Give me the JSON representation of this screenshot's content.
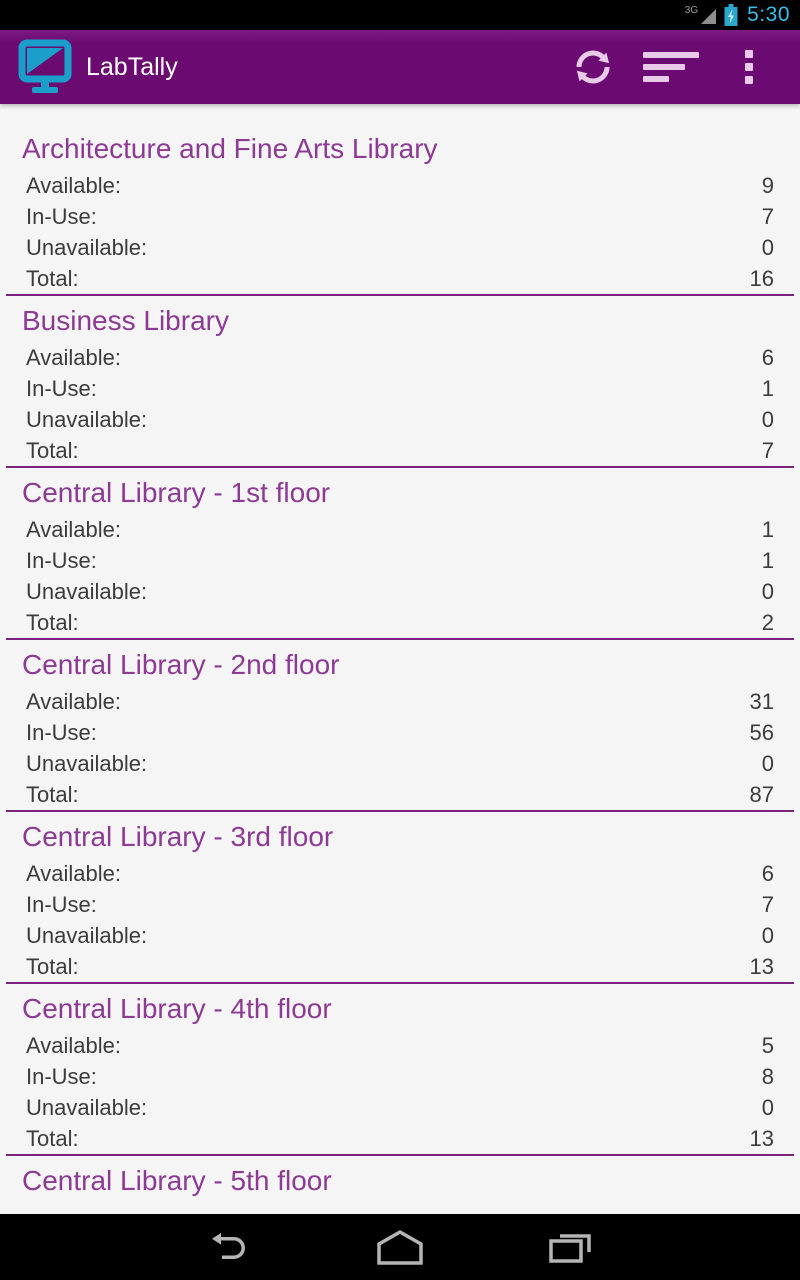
{
  "status_bar": {
    "network": "3G",
    "time": "5:30",
    "battery_state": "charging"
  },
  "action_bar": {
    "title": "LabTally",
    "app_icon": "monitor-icon",
    "buttons": [
      {
        "name": "refresh",
        "icon": "refresh-icon"
      },
      {
        "name": "sort",
        "icon": "sort-icon"
      },
      {
        "name": "overflow",
        "icon": "overflow-menu-icon"
      }
    ]
  },
  "row_labels": {
    "available": "Available:",
    "in_use": "In-Use:",
    "unavailable": "Unavailable:",
    "total": "Total:"
  },
  "row_keys": [
    "available",
    "in_use",
    "unavailable",
    "total"
  ],
  "sections": [
    {
      "name": "Architecture and Fine Arts Library",
      "available": 9,
      "in_use": 7,
      "unavailable": 0,
      "total": 16
    },
    {
      "name": "Business Library",
      "available": 6,
      "in_use": 1,
      "unavailable": 0,
      "total": 7
    },
    {
      "name": "Central Library - 1st floor",
      "available": 1,
      "in_use": 1,
      "unavailable": 0,
      "total": 2
    },
    {
      "name": "Central Library - 2nd floor",
      "available": 31,
      "in_use": 56,
      "unavailable": 0,
      "total": 87
    },
    {
      "name": "Central Library - 3rd floor",
      "available": 6,
      "in_use": 7,
      "unavailable": 0,
      "total": 13
    },
    {
      "name": "Central Library - 4th floor",
      "available": 5,
      "in_use": 8,
      "unavailable": 0,
      "total": 13
    },
    {
      "name": "Central Library - 5th floor",
      "partial": true
    }
  ],
  "nav_bar": {
    "buttons": [
      {
        "name": "back",
        "icon": "back-icon"
      },
      {
        "name": "home",
        "icon": "home-icon"
      },
      {
        "name": "recents",
        "icon": "recents-icon"
      }
    ]
  },
  "colors": {
    "action_bar": "#6B0B72",
    "header_text": "#8C3A94",
    "divider": "#79227F",
    "row_text": "#3C3C3C",
    "background": "#F6F5F6",
    "holo_blue": "#3ABDE8",
    "icon_teal": "#1B9EC9",
    "actionbar_icon": "#E9CBE9",
    "nav_icon": "#B5B5B5"
  }
}
